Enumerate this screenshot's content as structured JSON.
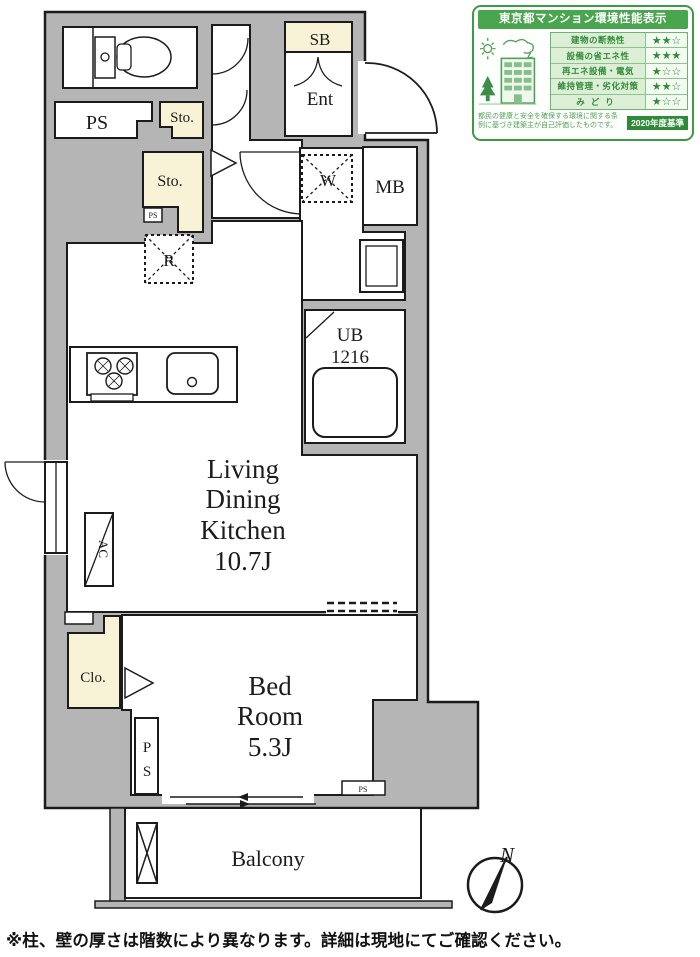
{
  "certificate": {
    "title": "東京都マンション環境性能表示",
    "rows": [
      {
        "label": "建物の断熱性",
        "stars": "★★☆"
      },
      {
        "label": "設備の省エネ性",
        "stars": "★★★"
      },
      {
        "label": "再エネ設備・電気",
        "stars": "★☆☆"
      },
      {
        "label": "維持管理・劣化対策",
        "stars": "★★☆"
      },
      {
        "label": "みどり",
        "stars": "★☆☆"
      }
    ],
    "footer": "都民の健康と安全を確保する環境に関する条例に基づき建築主が自己評価したものです。",
    "year_badge": "2020年度基準"
  },
  "plan": {
    "rooms": {
      "ldk": {
        "lines": [
          "Living",
          "Dining",
          "Kitchen",
          "10.7J"
        ]
      },
      "bedroom": {
        "lines": [
          "Bed",
          "Room",
          "5.3J"
        ]
      },
      "balcony": "Balcony",
      "entrance": "Ent",
      "shoe_box": "SB",
      "storage_upper": "Sto.",
      "storage_lower": "Sto.",
      "pipe_space_top": "PS",
      "pipe_space_small_upper": "PS",
      "pipe_space_vertical": [
        "P",
        "S"
      ],
      "pipe_space_small_lower": "PS",
      "meter_box": "MB",
      "washer": "W",
      "refrigerator": "R",
      "unit_bath": [
        "UB",
        "1216"
      ],
      "closet": "Clo.",
      "air_conditioner": "AC"
    },
    "compass_label": "N"
  },
  "footnote": "※柱、壁の厚さは階数により異なります。詳細は現地にてご確認ください。",
  "colors": {
    "wall_gray": "#b5b5b5",
    "line_black": "#1b1b1b",
    "storage_yellow": "#f8f3d7",
    "cert_green": "#3d9a45"
  }
}
